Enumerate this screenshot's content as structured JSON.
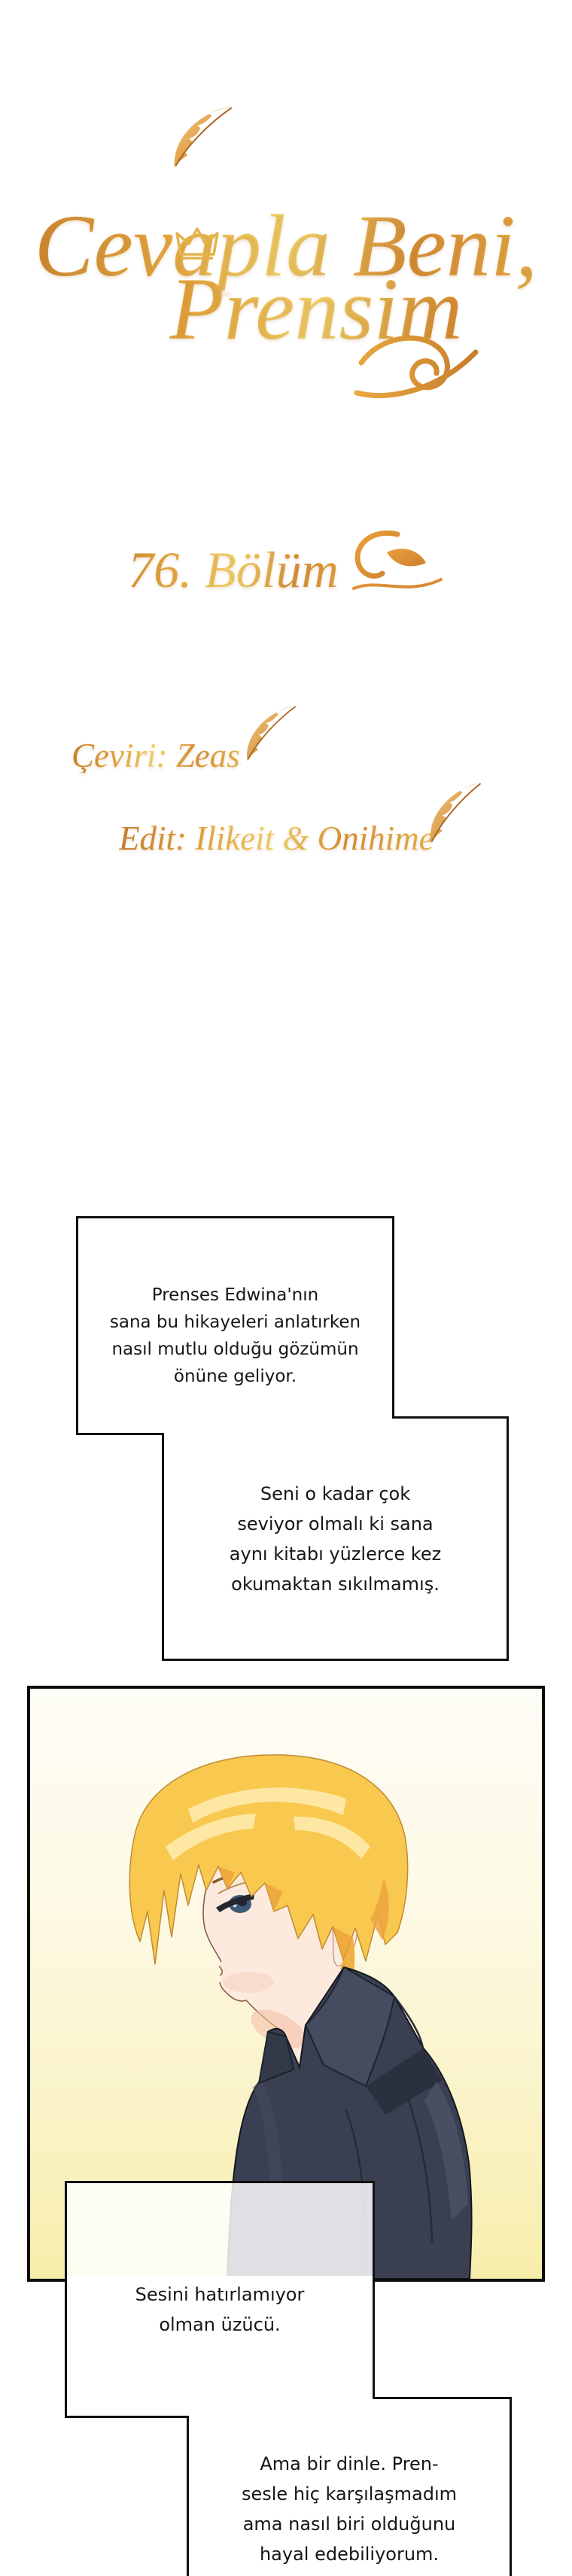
{
  "series": {
    "title_line1": "Cevapla Beni,",
    "title_line2": "Prensim"
  },
  "chapter": {
    "label": "76. Bölüm"
  },
  "credits": {
    "translator": "Çeviri: Zeas",
    "editor": "Edit: Ilikeit & Onihime"
  },
  "bubbles": [
    {
      "lines": [
        "Prenses Edwina'nın",
        "sana bu hikayeleri anlatırken",
        "nasıl mutlu olduğu gözümün",
        "önüne geliyor."
      ]
    },
    {
      "lines": [
        "Seni o kadar çok",
        "seviyor olmalı ki sana",
        "aynı kitabı yüzlerce kez",
        "okumaktan sıkılmamış."
      ]
    },
    {
      "lines": [
        "Sesini hatırlamıyor",
        "olman üzücü."
      ]
    },
    {
      "lines": [
        "Ama bir dinle. Pren-",
        "sesle hiç karşılaşmadım",
        "ama nasıl biri olduğunu",
        "hayal edebiliyorum."
      ]
    }
  ],
  "illustration": {
    "subject": "blonde-young-man-profile-dark-shirt"
  },
  "icons": {
    "feather": "feather-quill-icon",
    "crown": "crown-icon",
    "flourish": "calligraphic-swirl-icon",
    "chapter_ornament": "leaf-swirl-icon"
  },
  "colors": {
    "gold_accent": "#d9913d",
    "gold_light": "#f6d96e",
    "bubble_border": "#101010",
    "bubble_text": "#161616",
    "panel_bg_top": "#fefdf6",
    "panel_bg_bottom": "#f7eeab",
    "hair": "#f9c84e",
    "hair_highlight": "#fde7a3",
    "hair_shadow": "#eda43d",
    "skin": "#fdeade",
    "shirt": "#3a4052",
    "shirt_dark": "#2b303e"
  }
}
